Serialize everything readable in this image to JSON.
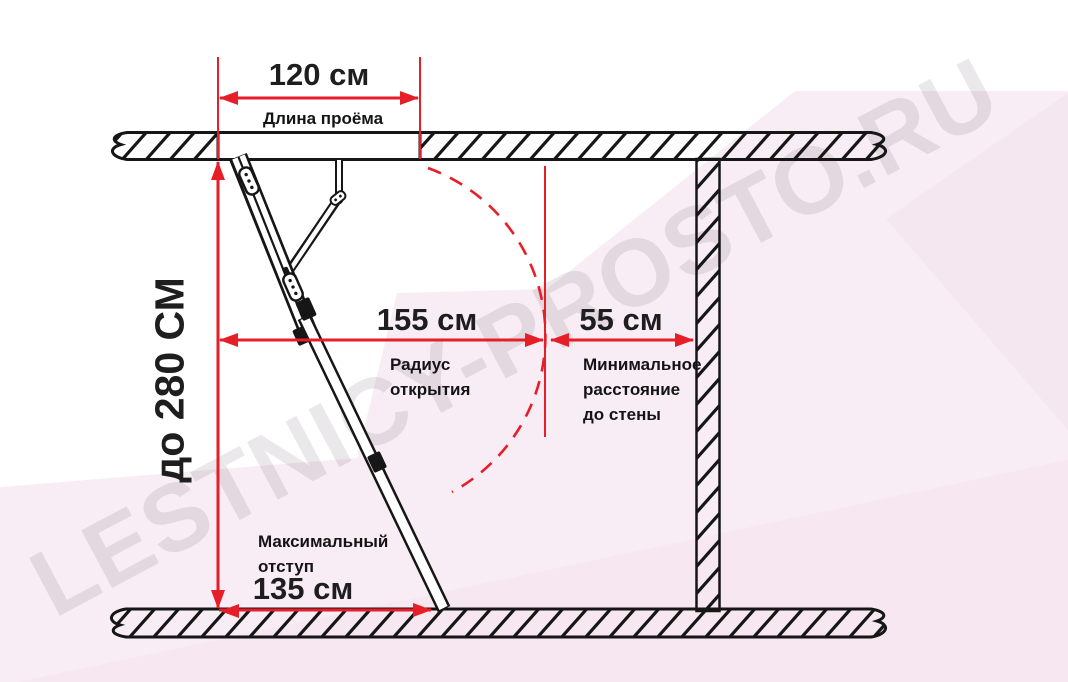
{
  "watermark": "LESTNICY-PROSTO.RU",
  "colors": {
    "accent_red": "#e61e28",
    "ink": "#161616",
    "bg_pink_light": "#f8edf4",
    "bg_pink_deep": "#f3e1ec",
    "watermark_gray": "rgba(95,78,95,0.13)"
  },
  "dimensions": {
    "opening": {
      "value": "120 см",
      "label": "Длина проёма"
    },
    "ceiling_height": {
      "value": "до 280 СМ"
    },
    "opening_radius": {
      "value": "155 см",
      "label": "Радиус\nоткрытия"
    },
    "wall_distance": {
      "value": "55 см",
      "label": "Минимальное\nрасстояние\nдо стены"
    },
    "max_offset": {
      "value": "135 см",
      "label": "Максимальный\nотступ"
    }
  }
}
